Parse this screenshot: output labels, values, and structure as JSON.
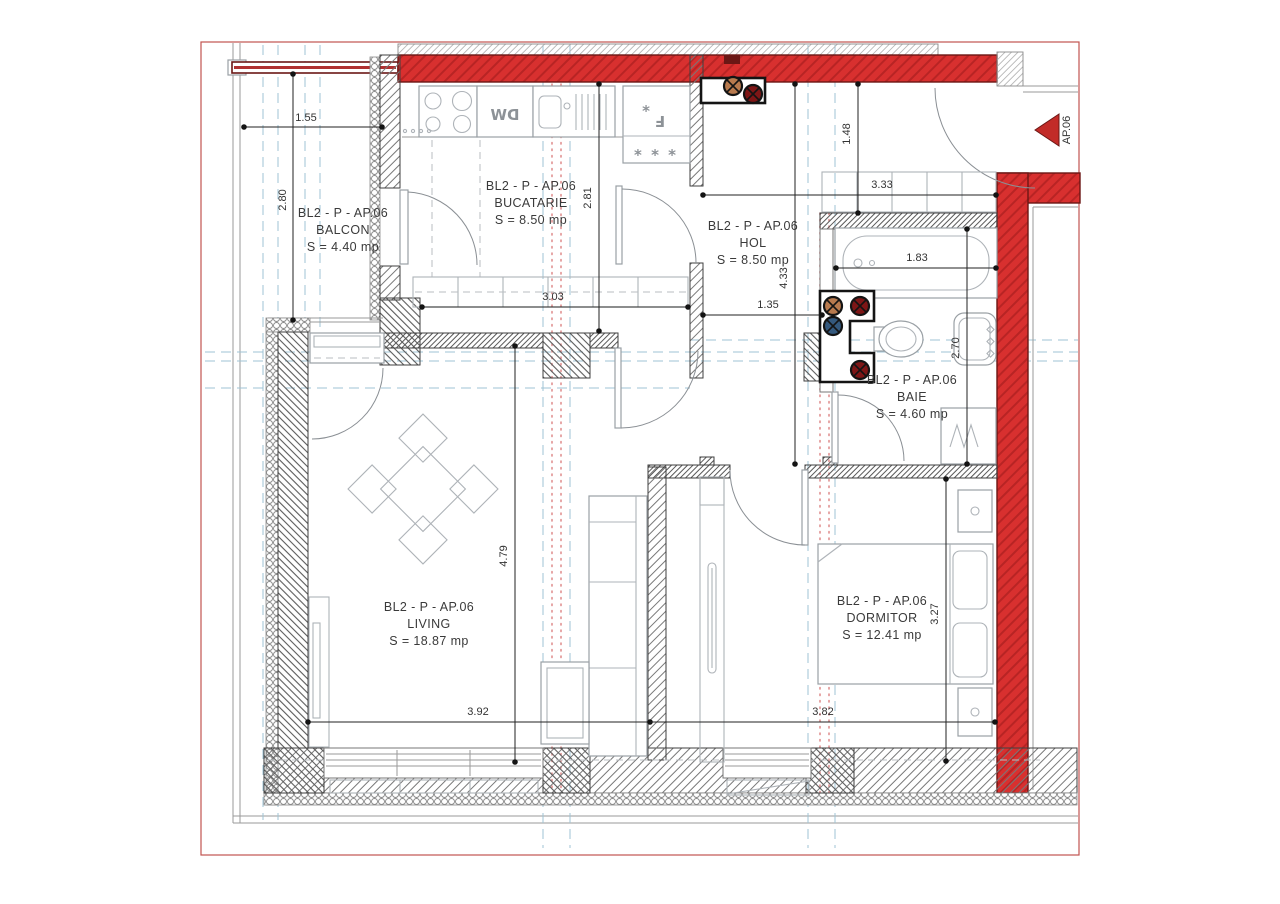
{
  "marker": {
    "label": "AP.06"
  },
  "colors": {
    "structural_red": "#d8302f",
    "structural_red_dark": "#6b1715",
    "sheet_border": "#c2544f",
    "axis_blue": "#9fc3d4",
    "dim_line": "#222222",
    "riser_tan": "#b87a4e",
    "riser_red": "#7e1616",
    "riser_blue": "#34597e"
  },
  "rooms": {
    "balcon": {
      "code": "BL2 - P - AP.06",
      "name": "BALCON",
      "area": "S = 4.40 mp"
    },
    "bucatarie": {
      "code": "BL2 - P - AP.06",
      "name": "BUCATARIE",
      "area": "S = 8.50 mp"
    },
    "hol": {
      "code": "BL2 - P - AP.06",
      "name": "HOL",
      "area": "S = 8.50 mp"
    },
    "baie": {
      "code": "BL2 - P - AP.06",
      "name": "BAIE",
      "area": "S = 4.60 mp"
    },
    "living": {
      "code": "BL2 - P - AP.06",
      "name": "LIVING",
      "area": "S = 18.87 mp"
    },
    "dormitor": {
      "code": "BL2 - P - AP.06",
      "name": "DORMITOR",
      "area": "S = 12.41 mp"
    }
  },
  "dims": {
    "balcon_w": "1.55",
    "balcon_h": "2.80",
    "kitchen_w": "3.03",
    "kitchen_h": "2.81",
    "hol_top": "1.48",
    "hol_w": "3.33",
    "hol_h": "4.33",
    "hol_pass": "1.35",
    "tub_w": "1.83",
    "baie_h": "2.70",
    "living_h": "4.79",
    "living_w": "3.92",
    "dorm_w": "3.82",
    "dorm_h": "3.27"
  },
  "appliances": {
    "dishwasher": "DW",
    "freezer_star": "*",
    "freezer_f": "F",
    "freezer_stars": "* * *"
  }
}
